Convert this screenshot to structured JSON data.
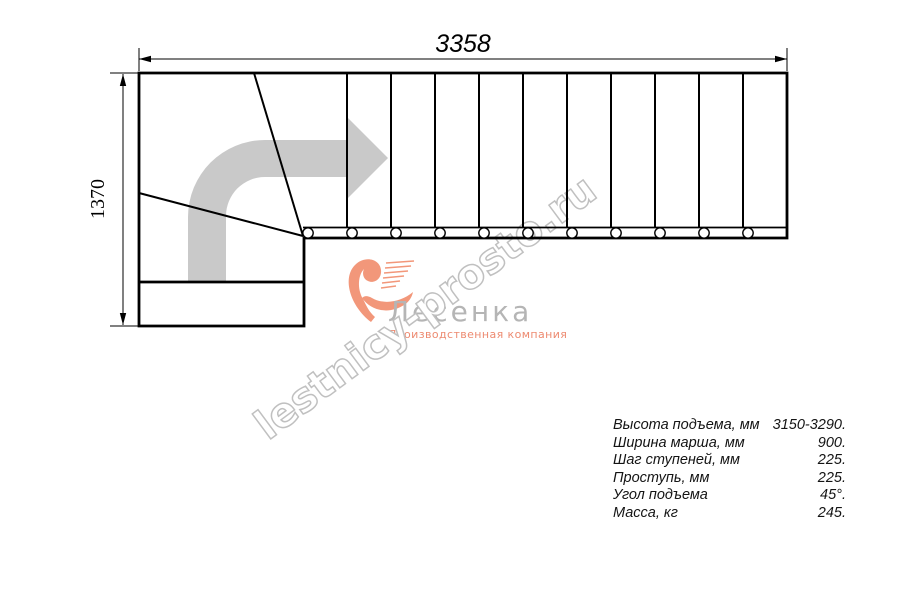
{
  "dimension_labels": {
    "total_length": "3358",
    "total_width": "1370"
  },
  "watermark": {
    "text": "lestnicy-prosto.ru"
  },
  "logo": {
    "name": "Лесенка",
    "tagline": "Производственная компания"
  },
  "spec_table": {
    "rows": [
      {
        "label": "Высота подъема, мм",
        "value": "3150-3290."
      },
      {
        "label": "Ширина марша, мм",
        "value": "900."
      },
      {
        "label": "Шаг ступеней, мм",
        "value": "225."
      },
      {
        "label": "Проступь, мм",
        "value": "225."
      },
      {
        "label": "Угол подъема",
        "value": "45°."
      },
      {
        "label": "Масса, кг",
        "value": "245."
      }
    ]
  },
  "colors": {
    "line": "#000000",
    "direction_arrow": "#c9c9c9",
    "watermark_outline": "#c0c0c0",
    "logo_text_gray": "#b5b5b5",
    "logo_accent": "#f2977a"
  }
}
